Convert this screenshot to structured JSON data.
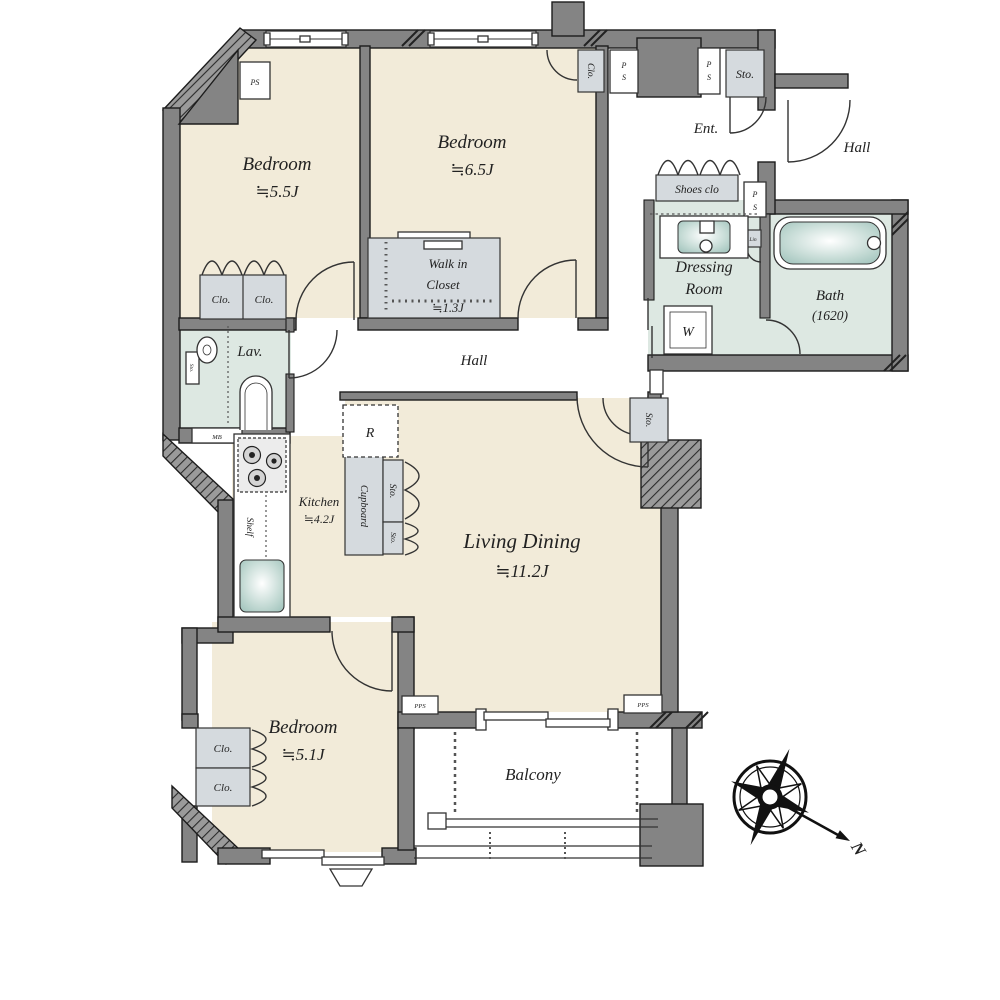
{
  "colors": {
    "floor_cream": "#f2ebd9",
    "wet_green": "#dde8e2",
    "closet_gray": "#d5dade",
    "wall_gray": "#848484",
    "accent_teal": "#c9ded9"
  },
  "rooms": {
    "bedroom_a": {
      "name": "Bedroom",
      "area": "≒5.5J"
    },
    "bedroom_b": {
      "name": "Bedroom",
      "area": "≒6.5J"
    },
    "bedroom_c": {
      "name": "Bedroom",
      "area": "≒5.1J"
    },
    "living_dining": {
      "name": "Living Dining",
      "area": "≒11.2J"
    },
    "kitchen": {
      "name": "Kitchen",
      "area": "≒4.2J"
    },
    "walk_in_closet": {
      "name_line1": "Walk in",
      "name_line2": "Closet",
      "area": "≒1.3J"
    },
    "lavatory": {
      "name": "Lav."
    },
    "dressing_room": {
      "name_line1": "Dressing",
      "name_line2": "Room"
    },
    "bath": {
      "name": "Bath",
      "size": "(1620)"
    },
    "entrance": {
      "name": "Ent."
    },
    "hall_interior": {
      "name": "Hall"
    },
    "hall_exterior": {
      "name": "Hall"
    },
    "balcony": {
      "name": "Balcony"
    }
  },
  "fixtures": {
    "shoes_closet": "Shoes clo",
    "closet": "Clo.",
    "storage": "Sto.",
    "cupboard": "Cupboard",
    "shelf": "Shelf",
    "refrigerator": "R",
    "washer": "W",
    "linen": "Lin",
    "meter_box": "MB"
  },
  "labels": {
    "ps": "PS",
    "ps_p": "P",
    "ps_s": "S",
    "pps": "PPS"
  },
  "compass": {
    "north": "N"
  }
}
